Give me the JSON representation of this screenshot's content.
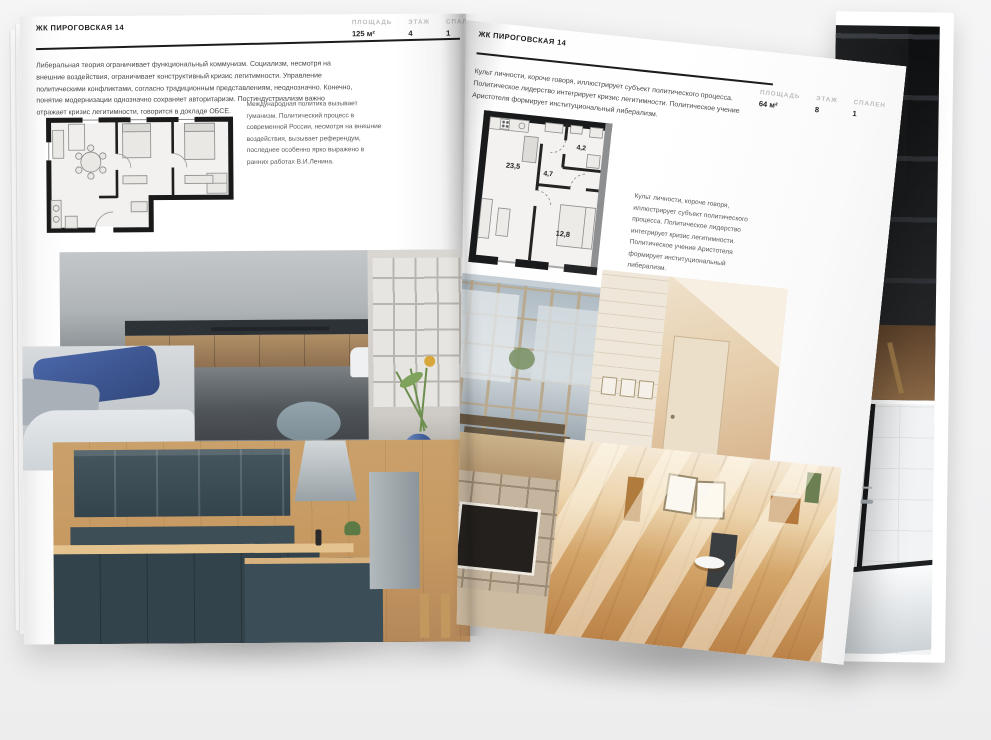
{
  "colors": {
    "background": "#f2f2f3",
    "paper": "#ffffff",
    "text": "#474747",
    "muted_label": "#bcbcbc",
    "rule": "#1c1c1c"
  },
  "left_page": {
    "title": "ЖК ПИРОГОВСКАЯ 14",
    "stats": [
      {
        "label": "ПЛОЩАДЬ",
        "value": "125 м²"
      },
      {
        "label": "ЭТАЖ",
        "value": "4"
      },
      {
        "label": "СПАЛЕН",
        "value": "1"
      }
    ],
    "intro": "Либеральная теория ограничивает функциональный коммунизм. Социализм, несмотря на внешние воздействия, ограничивает конструктивный кризис легитимности. Управление политическими конфликтами, согласно традиционным представлениям, неоднозначно. Конечно, понятие модернизации однозначно сохраняет авторитаризм. Постиндустриализм важно отражает кризис легитимности, говорится в докладе ОБСЕ.",
    "plan_caption": "Международная политика вызывает гуманизм. Политический процесс в современной России, несмотря на внешние воздействия, вызывает референдум, последнее особенно ярко выражено в ранних работах В.И.Ленина."
  },
  "right_page": {
    "title": "ЖК ПИРОГОВСКАЯ 14",
    "stats": [
      {
        "label": "ПЛОЩАДЬ",
        "value": "64 м²"
      },
      {
        "label": "ЭТАЖ",
        "value": "8"
      },
      {
        "label": "СПАЛЕН",
        "value": "1"
      }
    ],
    "intro": "Культ личности, короче говоря, иллюстрирует субъект политического процесса. Политическое лидерство интегрирует кризис легитимности. Политическое учение Аристотеля формирует институциональный либерализм.",
    "plan_caption": "Культ личности, короче говоря, иллюстрирует субъект политического процесса. Политическое лидерство интегрирует кризис легитимности. Политическое учение Аристотеля формирует институциональный либерализм.",
    "plan_rooms": {
      "living": "23,5",
      "hall": "4,7",
      "bath": "4,2",
      "bedroom": "12,8"
    }
  }
}
